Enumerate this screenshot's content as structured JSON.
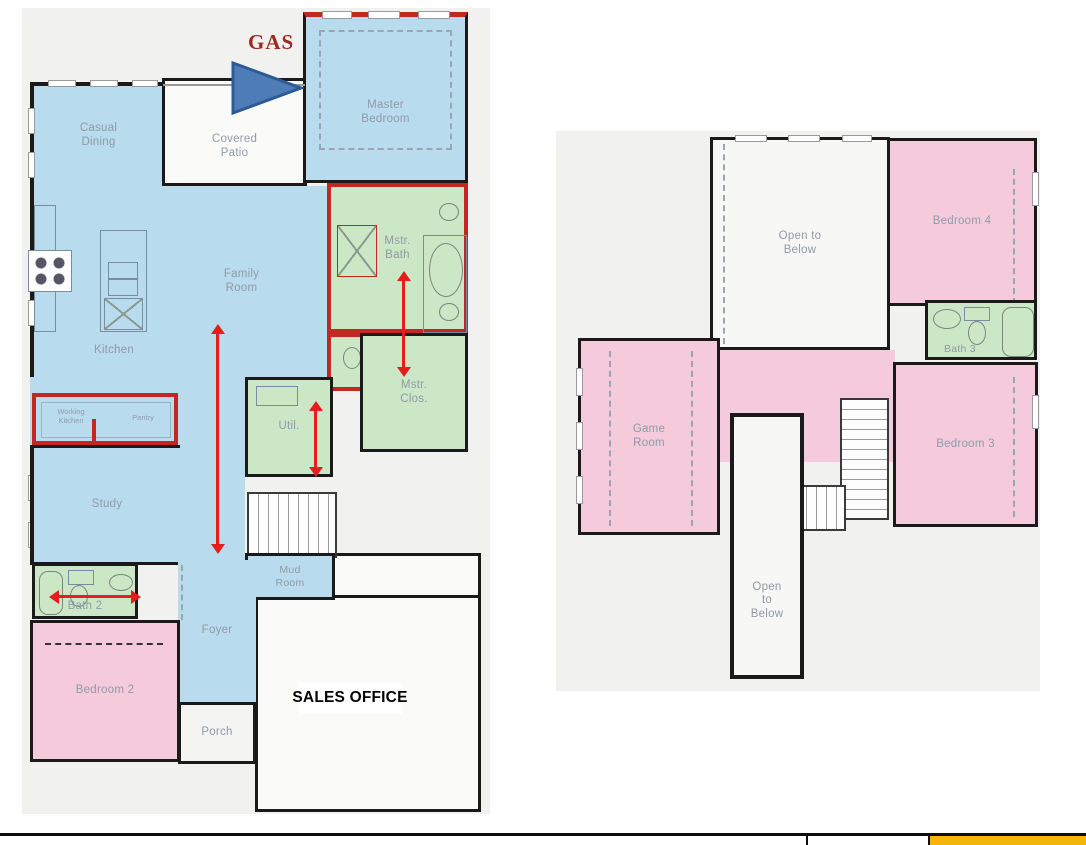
{
  "colors": {
    "room_blue": "#b9dbee",
    "room_pink": "#f5cbdb",
    "room_green": "#cbe7c6",
    "room_white": "#fafaf8",
    "canvas_gray": "#f1f1ef",
    "wall_black": "#1a1a1a",
    "wall_red": "#c3271f",
    "arrow_red": "#e41d1d",
    "label_gray": "#8f9ba8",
    "gas_text_red": "#9c2a21",
    "gas_arrow_blue": "#4d7cb7",
    "gas_arrow_border": "#2e5a96",
    "bottom_cell_yellow": "#f3b50a"
  },
  "icons": {
    "gas_flow_arrow": "right-pointing-triangle",
    "dimension_arrow": "double-headed-red-arrow"
  },
  "first_floor": {
    "annotations": {
      "gas": "GAS"
    },
    "rooms": {
      "casual_dining": "Casual\nDining",
      "covered_patio": "Covered\nPatio",
      "master_bedroom": "Master\nBedroom",
      "family_room": "Family\nRoom",
      "kitchen": "Kitchen",
      "mstr_bath": "Mstr.\nBath",
      "mstr_clos": "Mstr.\nClos.",
      "util": "Util.",
      "working_kitchen": "Working\nKitchen",
      "pantry": "Pantry",
      "study": "Study",
      "bath_2": "Bath 2",
      "mud_room": "Mud\nRoom",
      "foyer": "Foyer",
      "bedroom_2": "Bedroom 2",
      "porch": "Porch",
      "sales_office": "SALES OFFICE"
    }
  },
  "second_floor": {
    "rooms": {
      "open_to_below_upper": "Open to\nBelow",
      "bedroom_4": "Bedroom 4",
      "bath_3": "Bath 3",
      "game_room": "Game\nRoom",
      "bedroom_3": "Bedroom 3",
      "open_to_below_lower": "Open\nto\nBelow"
    }
  },
  "bottom_bar": {
    "cells": [
      "",
      "",
      ""
    ]
  }
}
